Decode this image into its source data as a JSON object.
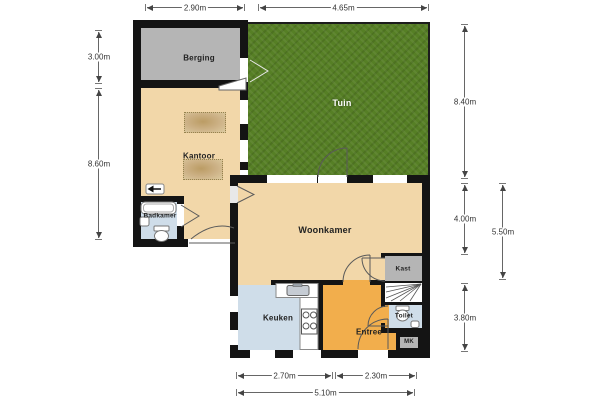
{
  "rooms": {
    "berging": "Berging",
    "kantoor": "Kantoor",
    "badkamer": "Badkamer",
    "tuin": "Tuin",
    "woonkamer": "Woonkamer",
    "kast": "Kast",
    "toilet": "Toilet",
    "entree": "Entree",
    "mk": "MK",
    "keuken": "Keuken"
  },
  "dimensions": {
    "top": {
      "berging_width": "2.90m",
      "tuin_width": "4.65m"
    },
    "left": {
      "berging_height": "3.00m",
      "kantoor_section_height": "8.60m"
    },
    "right": {
      "tuin_height": "8.40m",
      "woonkamer_depth": "4.00m",
      "keuken_row_height": "3.80m",
      "rear_section_height": "5.50m"
    },
    "bottom": {
      "keuken_width": "2.70m",
      "entree_width": "2.30m",
      "total_width": "5.10m"
    }
  },
  "icons": {
    "entrance_arrow": "left-arrow"
  },
  "colors": {
    "wall": "#141414",
    "floor_tan": "#f2d7a9",
    "floor_gray": "#b5b5b5",
    "floor_blue": "#cfdde9",
    "floor_orange": "#f2ae4c",
    "garden": "#567f25",
    "dimension_line": "#666666"
  }
}
